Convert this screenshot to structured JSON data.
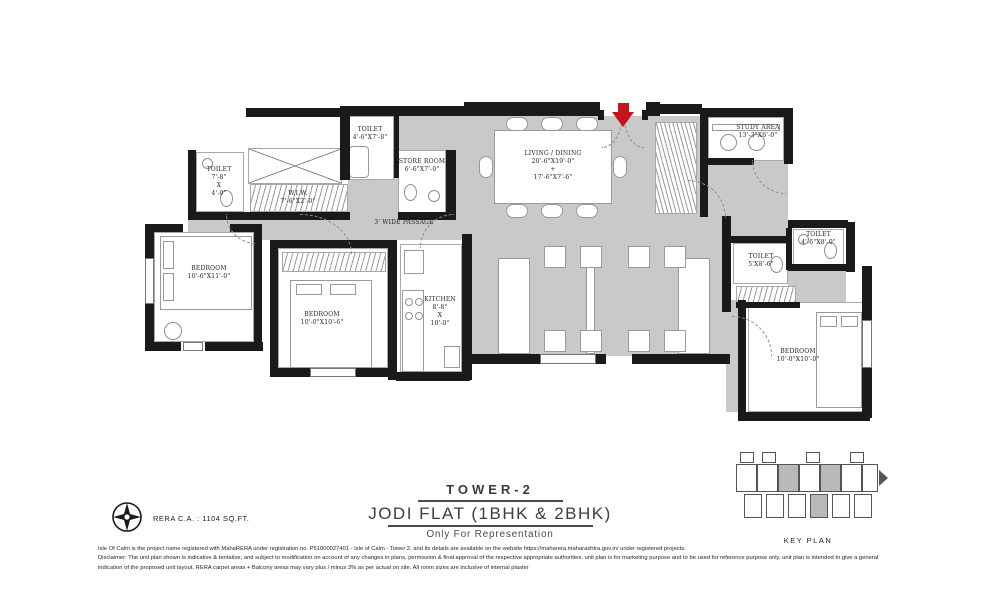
{
  "title_block": {
    "tower": "TOWER-2",
    "flat": "JODI FLAT (1BHK & 2BHK)",
    "tagline": "Only For Representation"
  },
  "rera": {
    "carpet_area": "RERA C.A. : 1104 SQ.FT."
  },
  "key_plan": {
    "label": "KEY PLAN"
  },
  "rooms": {
    "toilet_top_left": {
      "name": "TOILET",
      "dims": "4'-6\"X7'-8\""
    },
    "store_room": {
      "name": "STORE ROOM",
      "dims": "6'-6\"X7'-0\""
    },
    "toilet_left": {
      "name": "TOILET",
      "l1": "7'-8\"",
      "l2": "X",
      "l3": "4'-0\""
    },
    "wiw": {
      "name": "W.I.W.",
      "dims": "7'-6\"X2'-0\""
    },
    "passage": {
      "name": "3' WIDE PASSAGE"
    },
    "living_dining": {
      "name": "LIVING / DINING",
      "dims1": "20'-6\"X19'-0\"",
      "plus": "+",
      "dims2": "17'-6\"X7'-6\""
    },
    "study": {
      "name": "STUDY AREA",
      "dims": "13'-3\"X6'-0\""
    },
    "toilet_right_top": {
      "name": "TOILET",
      "dims": "4'-6\"X8'-0\""
    },
    "toilet_right": {
      "name": "TOILET",
      "dims": "5'X8'-6\""
    },
    "bedroom_left": {
      "name": "BEDROOM",
      "dims": "10'-6\"X11'-0\""
    },
    "bedroom_mid": {
      "name": "BEDROOM",
      "dims": "10'-0\"X10'-6\""
    },
    "kitchen": {
      "name": "KITCHEN",
      "l1": "8'-8\"",
      "l2": "X",
      "l3": "10'-0\""
    },
    "bedroom_right": {
      "name": "BEDROOM",
      "dims": "10'-0\"X10'-0\""
    }
  },
  "disclaimer": {
    "line1": "Isle Of Calm is the project name registered with MahaRERA under registration no. P51800027401 - Isle of Calm - Tower 2, and its details are available on the website https://maharera.maharashtra.gov.in/ under registered projects.",
    "line2": "Disclaimer: The unit plan shown is indicative & tentative, and subject to modification on account of any changes in plans, permission & final approval of the respective appropriate authorities. unit plan is for marketing purpose and to be used for reference purpose only. unit plan is intended to give a general",
    "line3": "indication of the proposed unit layout. RERA carpet areas + Balcony areas may vary plus / minus 3% as per actual on site. All room sizes are inclusive of internal plaster"
  },
  "colors": {
    "floor": "#c9c9c9",
    "wall": "#1a1a1a",
    "entry_arrow": "#c3161c"
  }
}
